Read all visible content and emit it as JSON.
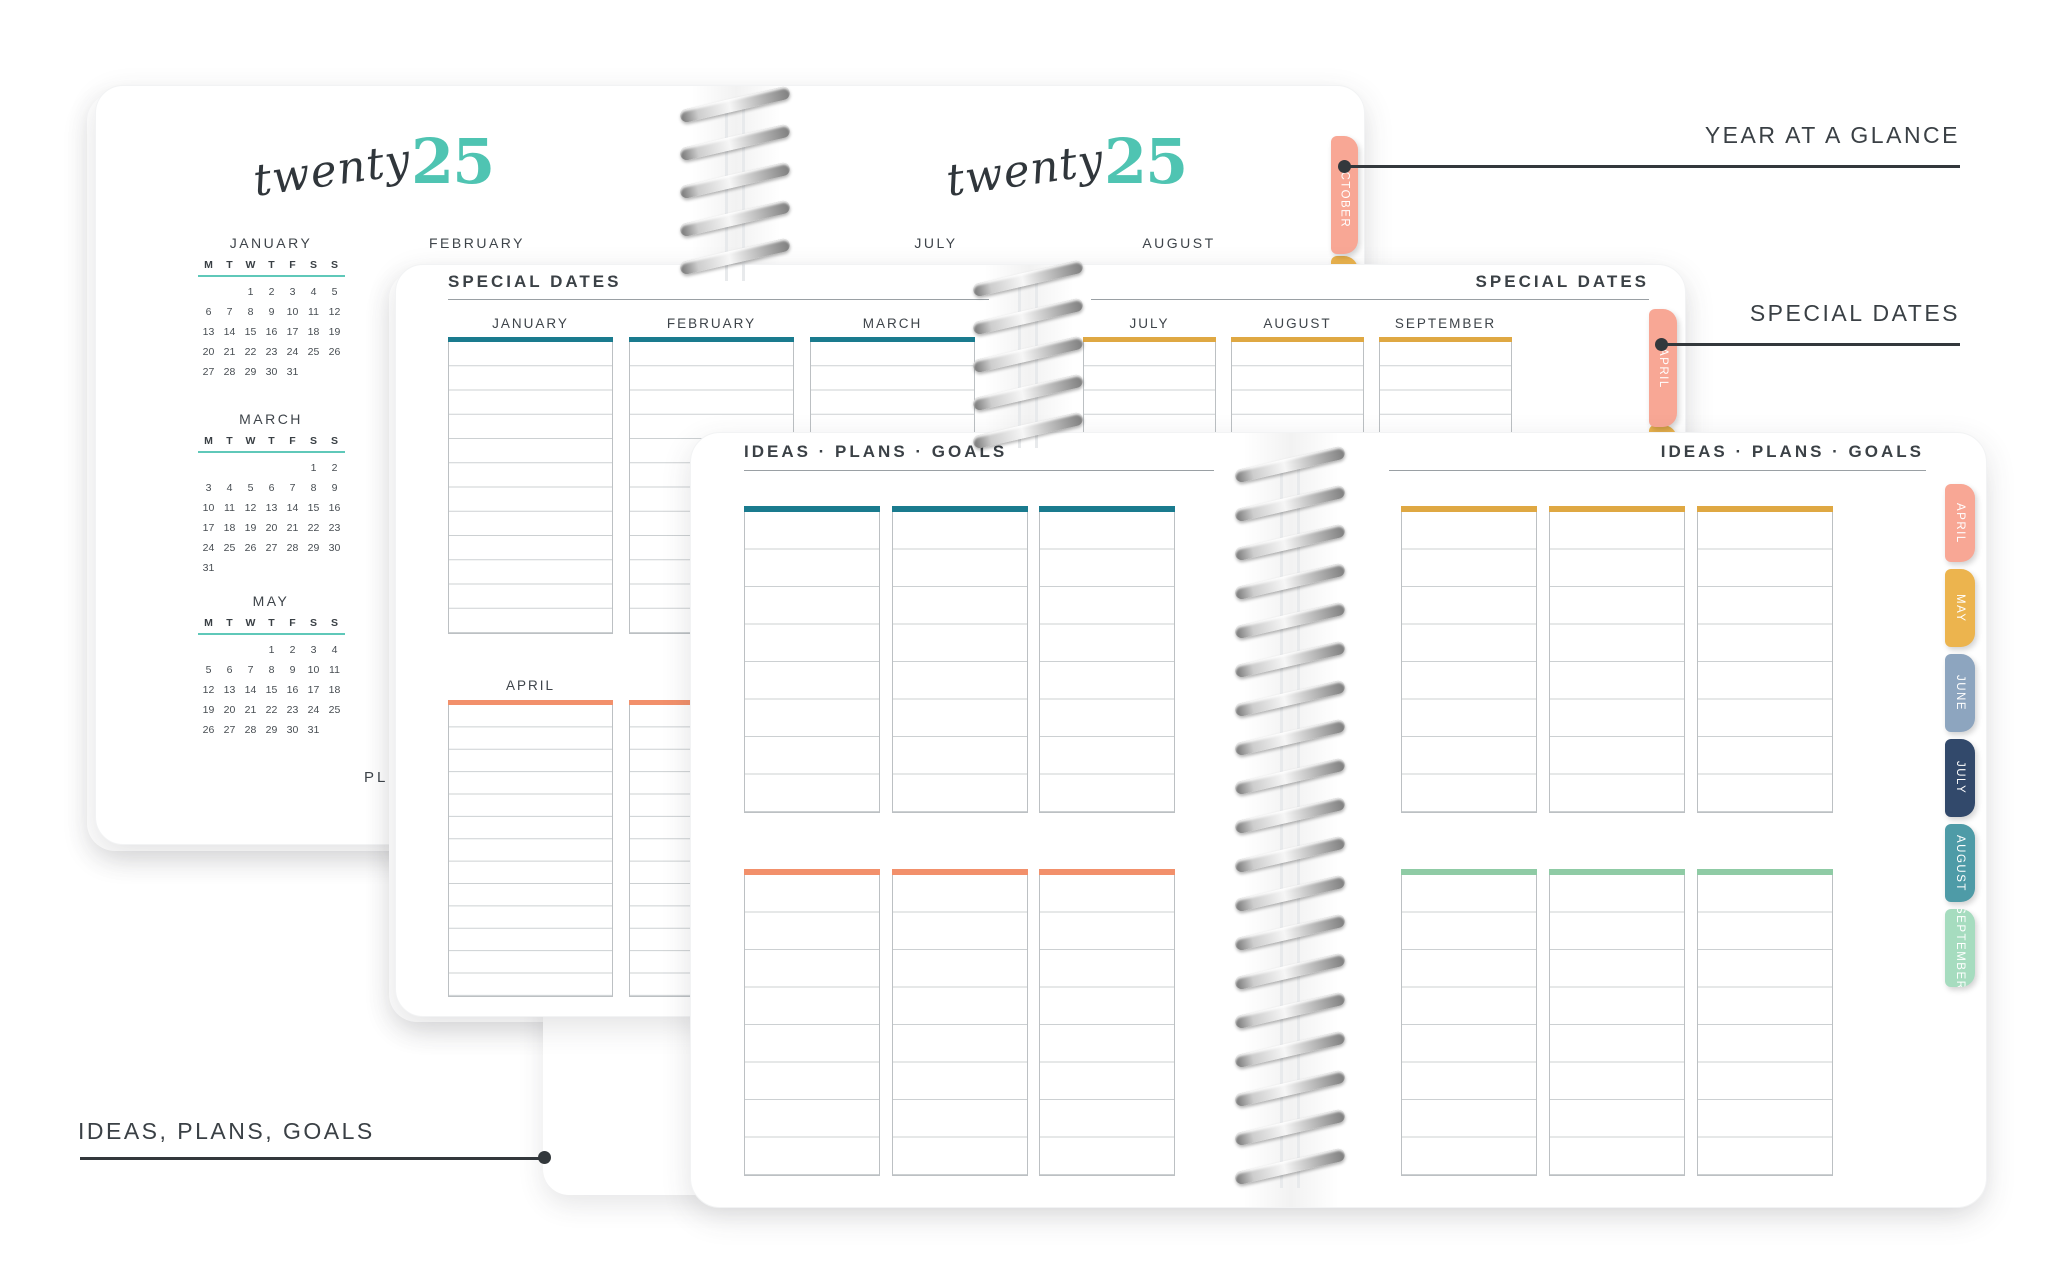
{
  "palette": {
    "teal_bar": "#1A7B8E",
    "gold_bar": "#DFA843",
    "orange_bar": "#F2906B",
    "mint_bar": "#8FCBA5",
    "logo_teal": "#4FC4B2",
    "calendar_rule_teal": "#5FC8B9",
    "tab_salmon": "#F8A795",
    "tab_gold": "#ECB44E",
    "tab_slate": "#8DA5BF",
    "tab_navy": "#32496B",
    "tab_teal": "#4E9BA7",
    "tab_mint": "#A6DCBF",
    "annotation": "#33383C"
  },
  "annotations": {
    "year_at_a_glance": "YEAR AT A GLANCE",
    "special_dates": "SPECIAL DATES",
    "ideas_plans_goals": "IDEAS, PLANS, GOALS"
  },
  "back_spread": {
    "logo": {
      "script": "twenty",
      "number": "25"
    },
    "day_headers": [
      "M",
      "T",
      "W",
      "T",
      "F",
      "S",
      "S"
    ],
    "calendars": [
      {
        "label": "JANUARY",
        "weeks": [
          [
            "",
            "",
            "1",
            "2",
            "3",
            "4",
            "5"
          ],
          [
            "6",
            "7",
            "8",
            "9",
            "10",
            "11",
            "12"
          ],
          [
            "13",
            "14",
            "15",
            "16",
            "17",
            "18",
            "19"
          ],
          [
            "20",
            "21",
            "22",
            "23",
            "24",
            "25",
            "26"
          ],
          [
            "27",
            "28",
            "29",
            "30",
            "31",
            "",
            ""
          ]
        ]
      },
      {
        "label": "MARCH",
        "weeks": [
          [
            "",
            "",
            "",
            "",
            "",
            "1",
            "2"
          ],
          [
            "3",
            "4",
            "5",
            "6",
            "7",
            "8",
            "9"
          ],
          [
            "10",
            "11",
            "12",
            "13",
            "14",
            "15",
            "16"
          ],
          [
            "17",
            "18",
            "19",
            "20",
            "21",
            "22",
            "23"
          ],
          [
            "24",
            "25",
            "26",
            "27",
            "28",
            "29",
            "30"
          ],
          [
            "31",
            "",
            "",
            "",
            "",
            "",
            ""
          ]
        ]
      },
      {
        "label": "MAY",
        "weeks": [
          [
            "",
            "",
            "",
            "1",
            "2",
            "3",
            "4"
          ],
          [
            "5",
            "6",
            "7",
            "8",
            "9",
            "10",
            "11"
          ],
          [
            "12",
            "13",
            "14",
            "15",
            "16",
            "17",
            "18"
          ],
          [
            "19",
            "20",
            "21",
            "22",
            "23",
            "24",
            "25"
          ],
          [
            "26",
            "27",
            "28",
            "29",
            "30",
            "31",
            ""
          ]
        ]
      }
    ],
    "label_only_months": [
      "FEBRUARY",
      "JULY",
      "AUGUST"
    ],
    "brand_partial": "PLU",
    "tab": {
      "label": "OCTOBER"
    }
  },
  "middle_spread": {
    "header_left": "SPECIAL DATES",
    "header_right": "SPECIAL DATES",
    "left_columns": [
      "JANUARY",
      "FEBRUARY",
      "MARCH"
    ],
    "right_columns": [
      "JULY",
      "AUGUST",
      "SEPTEMBER"
    ],
    "section2_label": "APRIL",
    "tab": {
      "label": "APRIL"
    }
  },
  "front_spread": {
    "header_left": "IDEAS · PLANS · GOALS",
    "header_right": "IDEAS · PLANS · GOALS",
    "tabs": [
      "APRIL",
      "MAY",
      "JUNE",
      "JULY",
      "AUGUST",
      "SEPTEMBER"
    ]
  }
}
